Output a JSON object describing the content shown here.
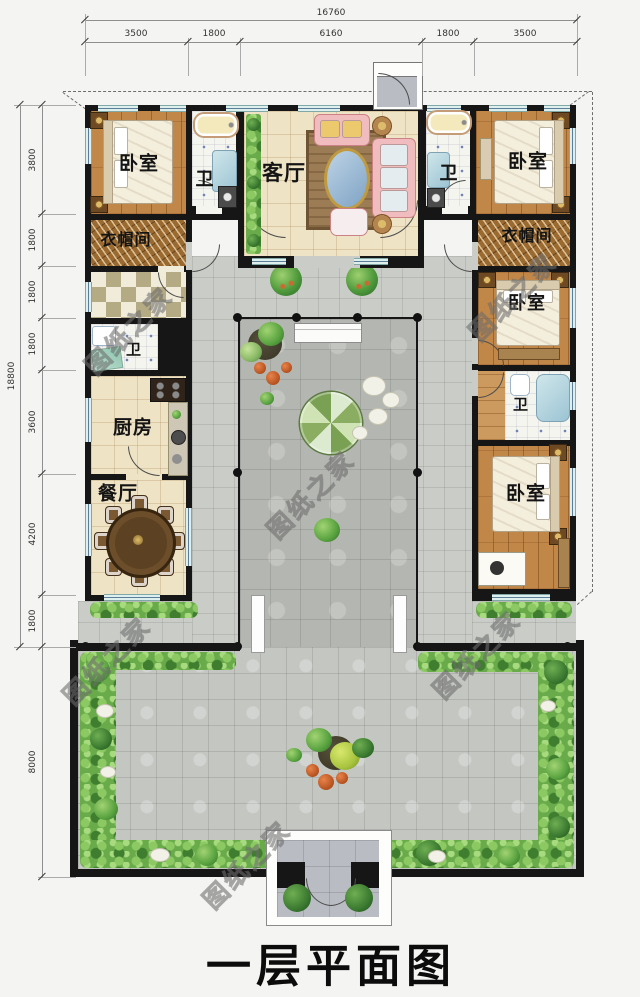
{
  "title": "一层平面图",
  "watermark": "图纸之家",
  "dimensions": {
    "top": {
      "total": "16760",
      "segments": [
        "3500",
        "1800",
        "6160",
        "1800",
        "3500"
      ]
    },
    "left": {
      "total": "18800",
      "segments": [
        "3800",
        "1800",
        "1800",
        "1800",
        "3600",
        "4200",
        "1800",
        "8000"
      ]
    }
  },
  "rooms": {
    "bedroom_nw": "卧室",
    "bath_nw": "卫",
    "living": "客厅",
    "bath_ne": "卫",
    "bedroom_ne": "卧室",
    "cloak_w": "衣帽间",
    "cloak_e": "衣帽间",
    "bath_w": "卫",
    "kitchen": "厨房",
    "dining": "餐厅",
    "bedroom_e": "卧室",
    "bath_e": "卫",
    "bedroom_se": "卧室"
  },
  "colors": {
    "wall": "#161616",
    "wood_floor": "#c08749",
    "cream_floor": "#efe3c6",
    "courtyard_tile": "#c6c9c4",
    "greenery": "#5ba343",
    "window_glass": "#ddf0ee",
    "title_text": "#0c0c0c"
  }
}
